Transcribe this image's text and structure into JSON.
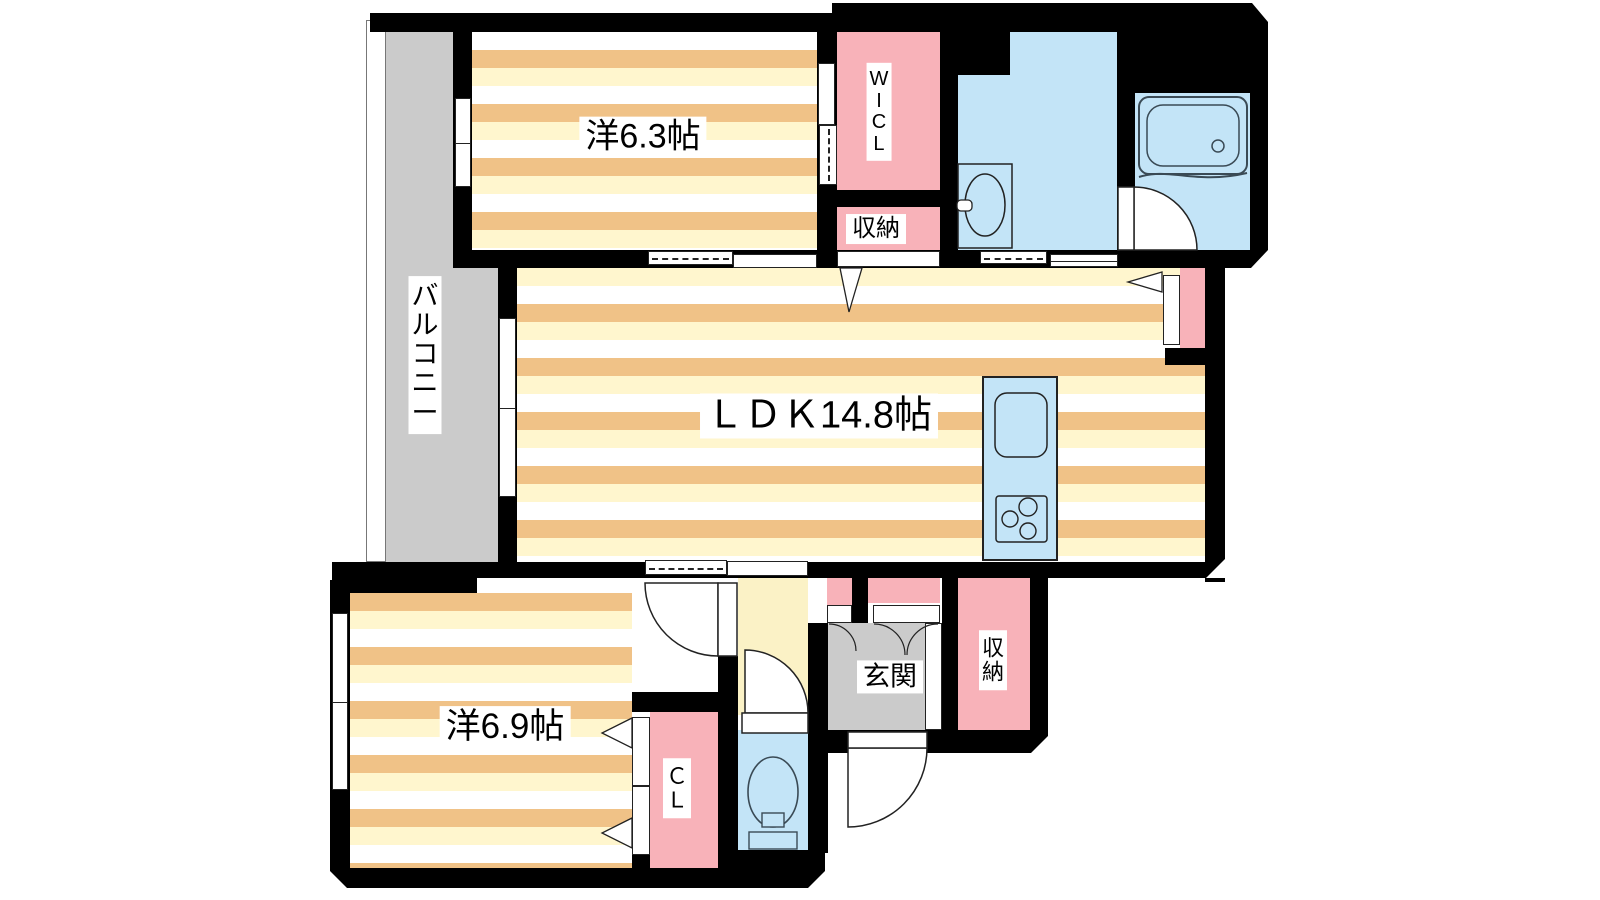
{
  "meta": {
    "type": "apartment-floor-plan"
  },
  "colors": {
    "wall": "#000000",
    "stripe_orange": "#F0C287",
    "stripe_cream": "#FFF6CE",
    "pink": "#F8B2B9",
    "blue": "#C3E4F7",
    "gray": "#CBCBCB",
    "hall": "#FBF2C6",
    "fixture_line": "#3A4A55"
  },
  "rooms": {
    "bedroom1": {
      "label": "洋6.3帖"
    },
    "bedroom2": {
      "label": "洋6.9帖"
    },
    "ldk": {
      "label": "ＬＤＫ14.8帖"
    },
    "genkan": {
      "label": "玄関"
    },
    "storage_top": {
      "label": "収納"
    },
    "storage_bottom": {
      "chars": [
        "収",
        "納"
      ]
    },
    "wicl": {
      "chars": [
        "W",
        "I",
        "C",
        "L"
      ]
    },
    "cl": {
      "chars": [
        "Ｃ",
        "Ｌ"
      ]
    },
    "balcony": {
      "chars": [
        "バ",
        "ル",
        "コ",
        "ニ",
        "ー"
      ]
    }
  }
}
